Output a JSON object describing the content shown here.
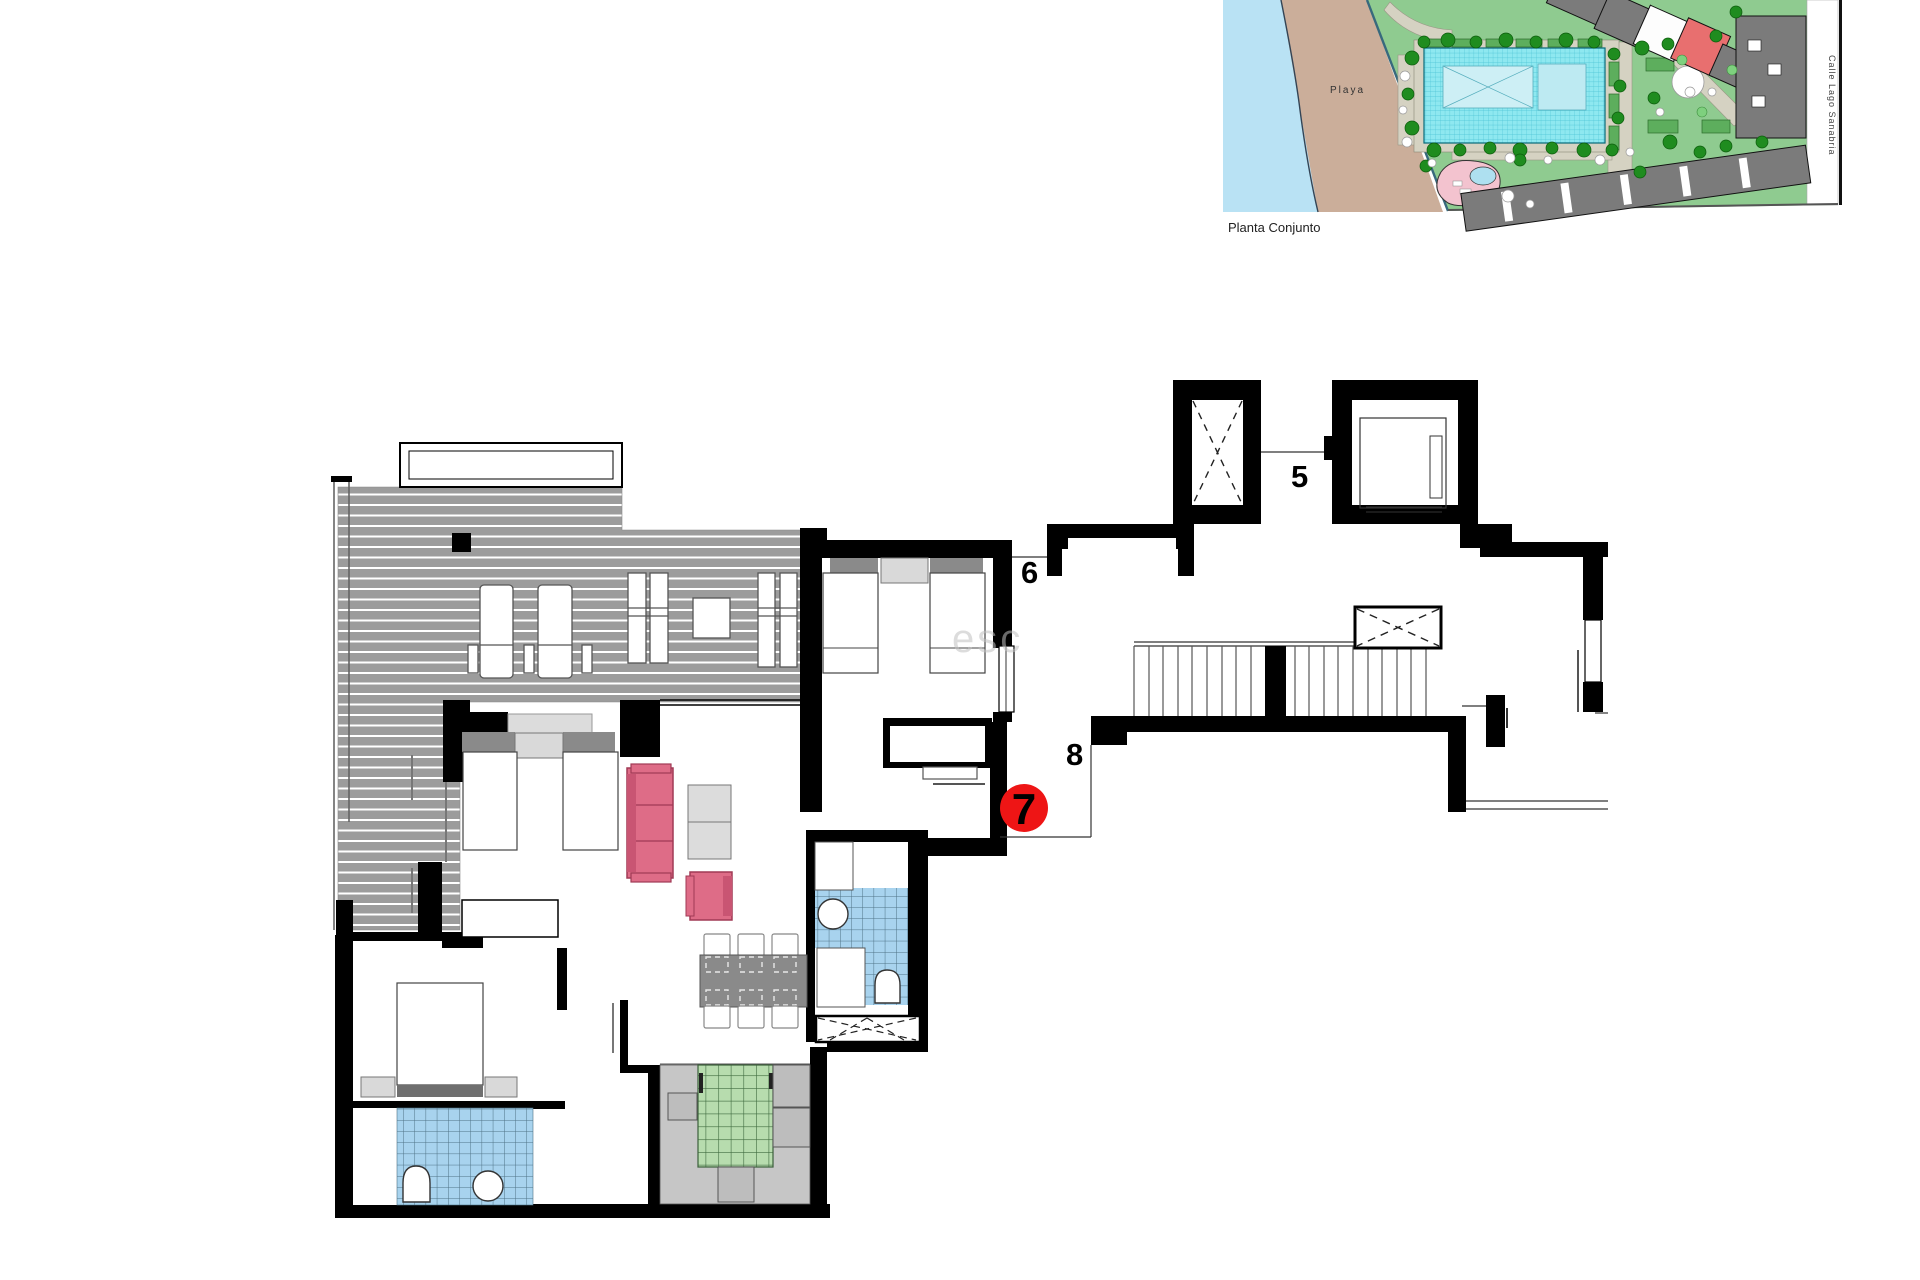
{
  "inset": {
    "caption": "Planta Conjunto",
    "beach_label": "Playa",
    "street_label": "Calle Lago Sanabria",
    "colors": {
      "water": "#b9e2f4",
      "sand": "#cbae9a",
      "grounds": "#8fcb90",
      "pool": "#8ee8f0",
      "buildings": "#7b7b7b",
      "highlight_building": "#e86f6f",
      "spa": "#f3c3cf"
    }
  },
  "plan": {
    "unit_labels": {
      "unit5": "5",
      "unit6": "6",
      "unit8": "8"
    },
    "unit_marker": {
      "number": "7",
      "color": "#ee1515"
    },
    "watermark": "esc",
    "colors": {
      "wall": "#000000",
      "terrace_deck": "#9c9c9c",
      "bathroom_tile": "#a8d3ee",
      "bed_green": "#b7dcae",
      "sofa_pink": "#de6c87",
      "furniture_gray": "#d9d9d9",
      "dining_table": "#8a8a8a",
      "room_floor": "#c6c6c6"
    }
  }
}
